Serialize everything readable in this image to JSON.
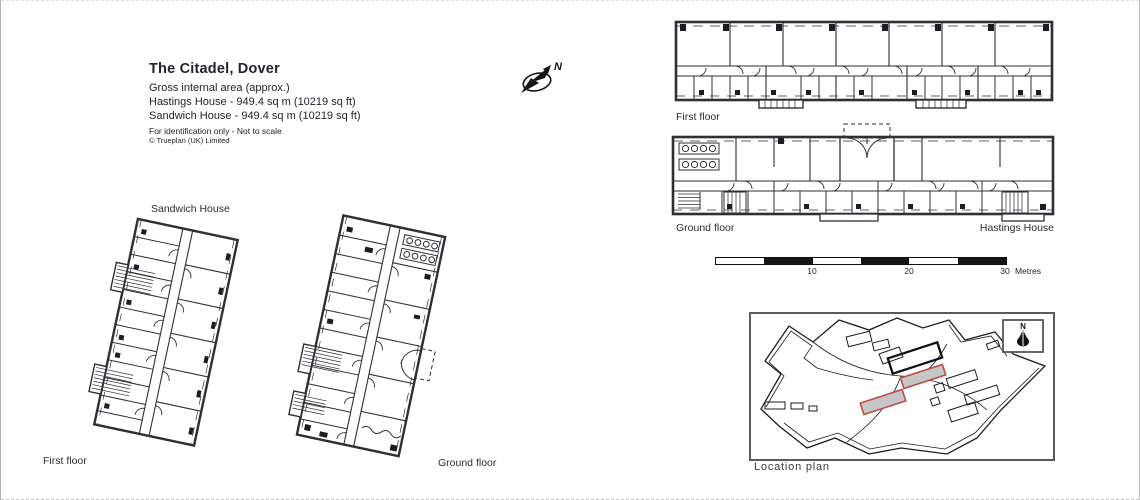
{
  "colors": {
    "text": "#23232c",
    "line": "#2f2f35",
    "highlight_stroke": "#bf4a47",
    "highlight_fill": "#c6c6c6",
    "page_bg": "#ffffff"
  },
  "title_block": {
    "title": "The Citadel, Dover",
    "subtitle": "Gross internal area (approx.)",
    "area_lines": [
      "Hastings House - 949.4 sq m (10219 sq ft)",
      "Sandwich House - 949.4 sq m (10219 sq ft)"
    ],
    "disclaimer": "For identification only - Not to scale",
    "copyright": "© Trueplan (UK) Limited"
  },
  "north_arrow": {
    "label": "N"
  },
  "sandwich": {
    "house_label": "Sandwich House",
    "first_floor_label": "First floor",
    "ground_floor_label": "Ground floor"
  },
  "hastings": {
    "house_label": "Hastings House",
    "first_floor_label": "First floor",
    "ground_floor_label": "Ground floor"
  },
  "scale_bar": {
    "ticks": [
      "10",
      "20",
      "30"
    ],
    "unit": "Metres",
    "segments": 6
  },
  "location_plan": {
    "label": "Location plan",
    "north_label": "N"
  }
}
